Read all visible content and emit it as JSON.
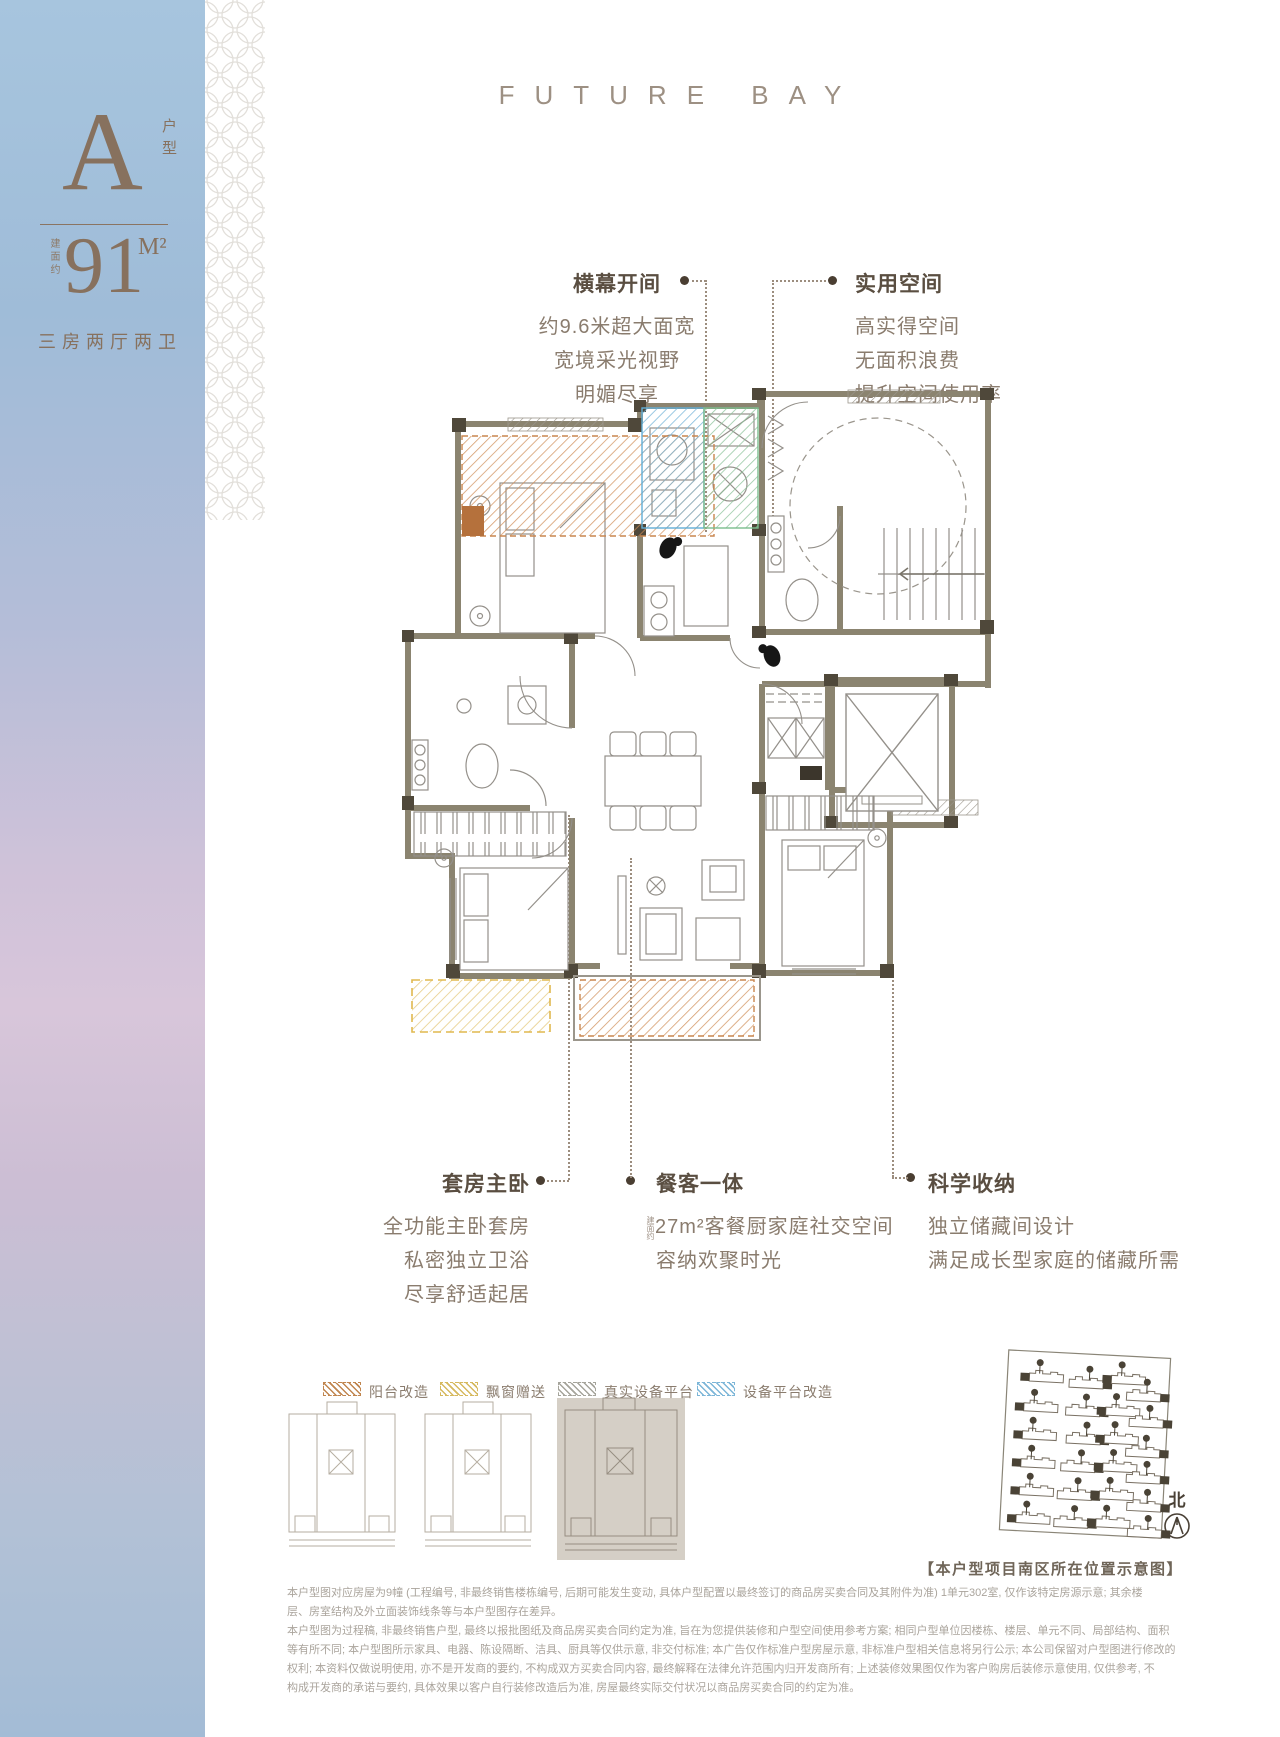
{
  "page": {
    "brand_title": "FUTURE BAY"
  },
  "sidebar": {
    "unit_letter": "A",
    "unit_type_vertical": "户型",
    "area_prefix": "建面约",
    "area_value": "91",
    "area_unit": "M²",
    "layout_desc": "三房两厅两卫",
    "text_color": "#87715e"
  },
  "annotations": {
    "top_left": {
      "title": "横幕开间",
      "lines": [
        "约9.6米超大面宽",
        "宽境采光视野",
        "明媚尽享"
      ]
    },
    "top_right": {
      "title": "实用空间",
      "lines": [
        "高实得空间",
        "无面积浪费",
        "提升空间使用率"
      ]
    },
    "bottom_left": {
      "title": "套房主卧",
      "lines": [
        "全功能主卧套房",
        "私密独立卫浴",
        "尽享舒适起居"
      ]
    },
    "bottom_mid": {
      "title": "餐客一体",
      "prefix_vertical": "建面约",
      "lines": [
        "27m²客餐厨家庭社交空间",
        "容纳欢聚时光"
      ]
    },
    "bottom_right": {
      "title": "科学收纳",
      "lines": [
        "独立储藏间设计",
        "满足成长型家庭的储藏所需"
      ]
    }
  },
  "legend": {
    "items": [
      {
        "label": "阳台改造",
        "color": "#c0854e"
      },
      {
        "label": "飘窗赠送",
        "color": "#d6b95e"
      },
      {
        "label": "真实设备平台",
        "color": "#a5a49b"
      },
      {
        "label": "设备平台改造",
        "color": "#7cb6d8"
      }
    ]
  },
  "plan_colors": {
    "wall": "#8b8470",
    "wall_dark_block": "#4f483a",
    "hatch_orange": "#c9854e",
    "hatch_yellow": "#e2bd55",
    "hatch_blue": "#6fb2d8",
    "hatch_green": "#86bf96",
    "hatch_gray": "#a5a49b"
  },
  "site_plan": {
    "caption": "【本户型项目南区所在位置示意图】",
    "north_label": "北"
  },
  "disclaimer": {
    "lines": [
      "本户型图对应房屋为9幢 (工程编号, 非最终销售楼栋编号, 后期可能发生变动, 具体户型配置以最终签订的商品房买卖合同及其附件为准) 1单元302室, 仅作该特定房源示意; 其余楼",
      "层、房室结构及外立面装饰线条等与本户型图存在差异。",
      "本户型图为过程稿, 非最终销售户型, 最终以报批图纸及商品房买卖合同约定为准, 旨在为您提供装修和户型空间使用参考方案; 相同户型单位因楼栋、楼层、单元不同、局部结构、面积",
      "等有所不同; 本户型图所示家具、电器、陈设隔断、洁具、厨具等仅供示意, 非交付标准; 本广告仅作标准户型房屋示意, 非标准户型相关信息将另行公示; 本公司保留对户型图进行修改的",
      "权利; 本资料仅做说明使用, 亦不是开发商的要约, 不构成双方买卖合同内容, 最终解释在法律允许范围内归开发商所有; 上述装修效果图仅作为客户购房后装修示意使用, 仅供参考, 不",
      "构成开发商的承诺与要约, 具体效果以客户自行装修改造后为准, 房屋最终实际交付状况以商品房买卖合同的约定为准。"
    ]
  }
}
